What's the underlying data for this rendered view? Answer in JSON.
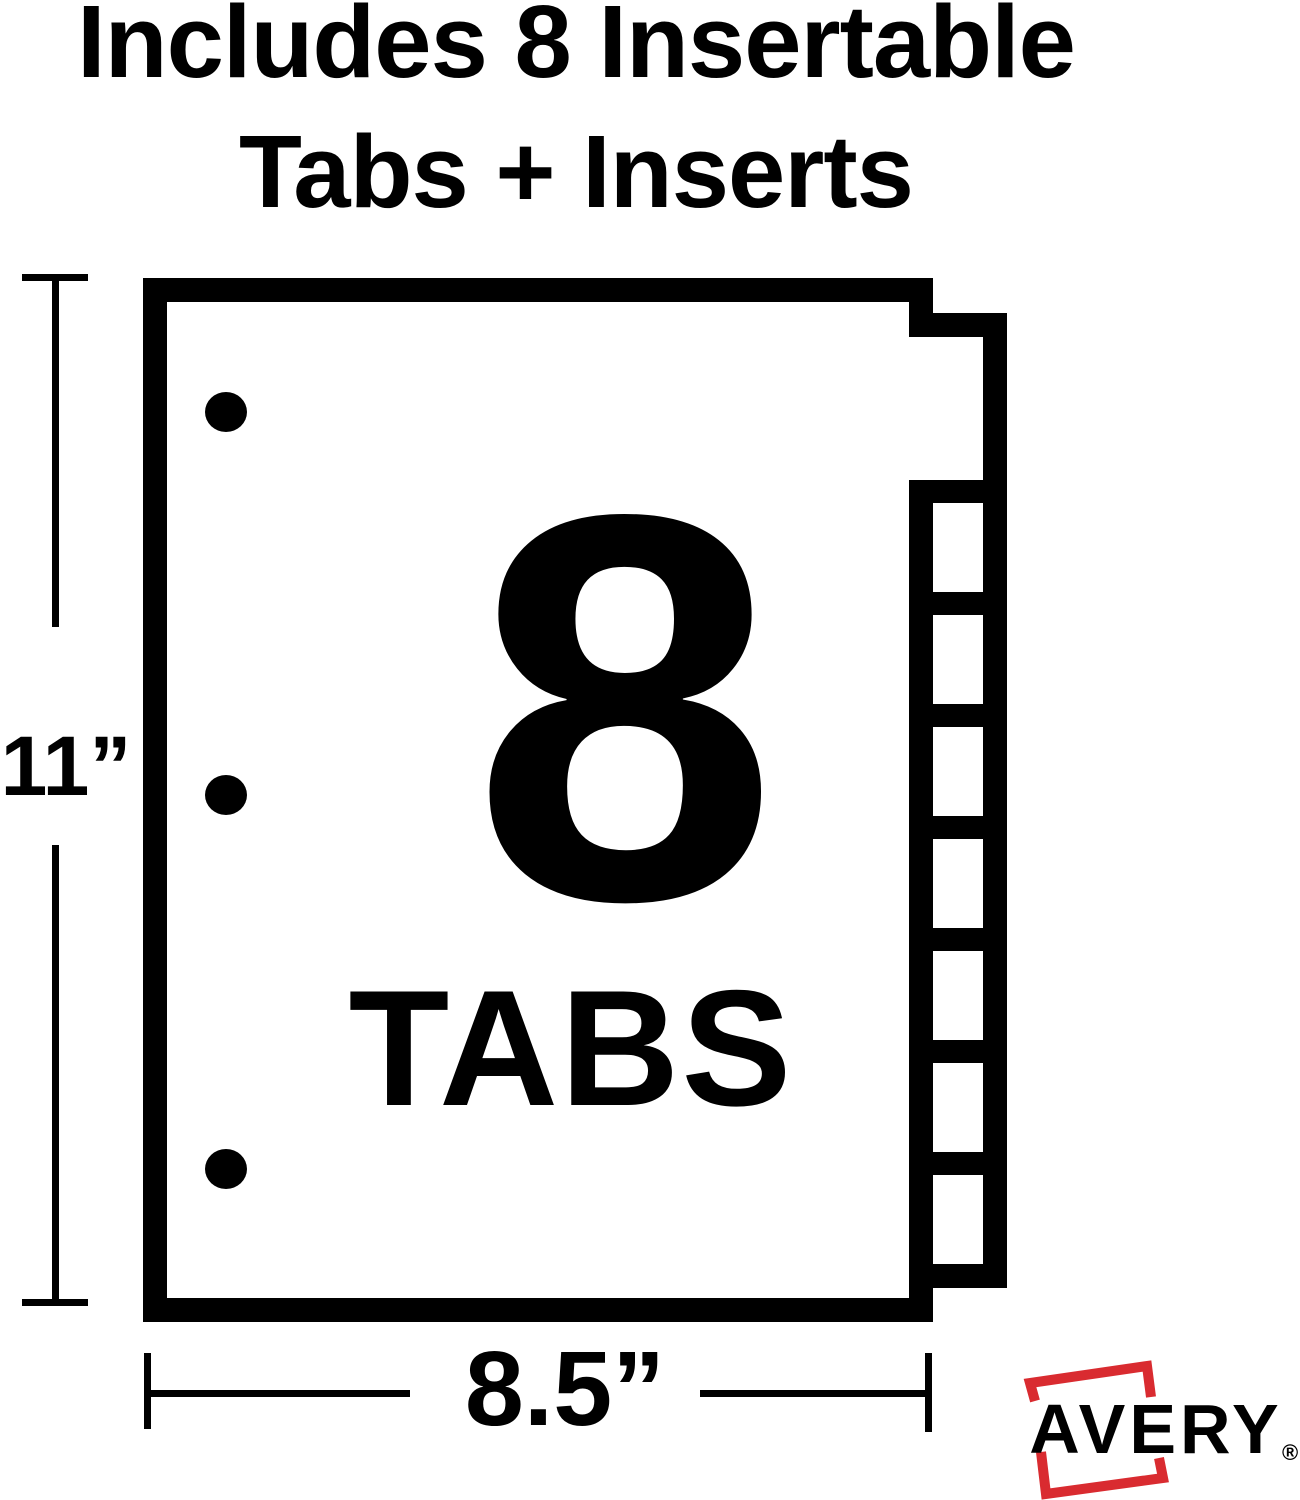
{
  "title": {
    "line1": "Includes 8 Insertable",
    "line2": "Tabs + Inserts",
    "color": "#1b3fa8"
  },
  "sheet": {
    "big_number": "8",
    "big_label": "TABS",
    "tabs_total": 8,
    "tab_windows": 7,
    "punch_holes": 3,
    "outline_color": "#000000"
  },
  "dimensions": {
    "height_label": "11”",
    "width_label": "8.5”"
  },
  "logo": {
    "brand": "AVERY",
    "registered_mark": "®",
    "blue": "#1b4696",
    "red": "#d92b30"
  }
}
